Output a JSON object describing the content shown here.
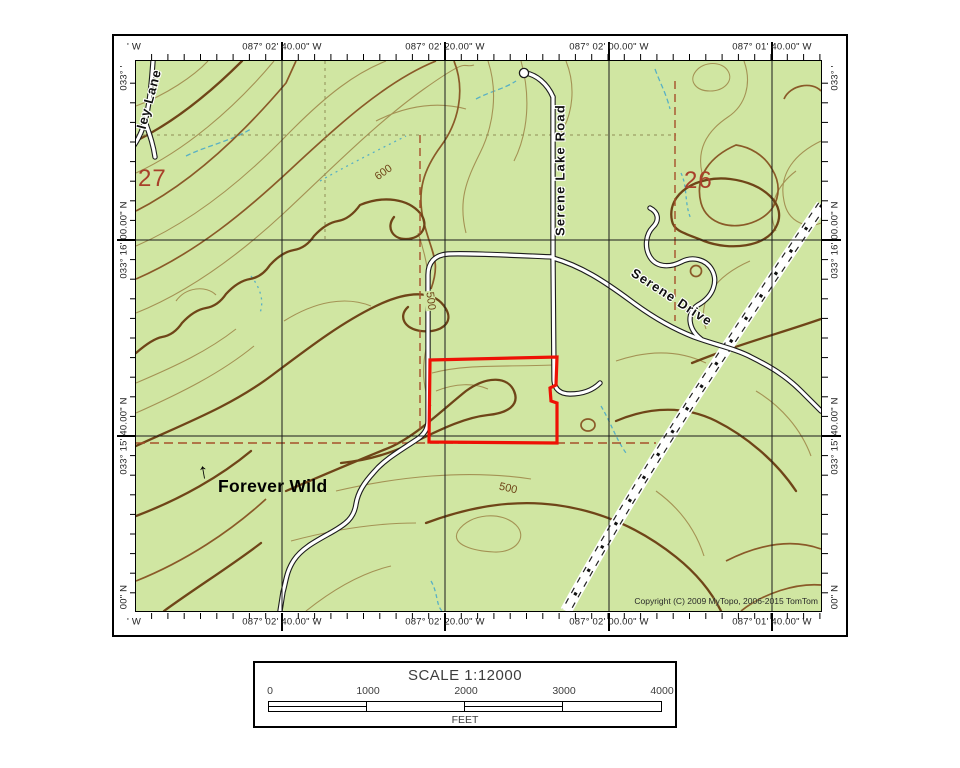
{
  "colors": {
    "map_green": "#d0e6a2",
    "contour_index": "#6f4518",
    "contour_medium": "#8a5a28",
    "contour_thin": "#a28e50",
    "stream": "#58b0c4",
    "grid": "#1a1a1a",
    "road_casing": "#1c1c1c",
    "road_fill": "#ffffff",
    "boundary_red": "#ee1105",
    "section_number": "#a8402a",
    "section_line": "#a5502a",
    "section_line_faint": "#8f8f55",
    "axis_text": "#222222"
  },
  "axis": {
    "top": [
      "' W",
      "087° 02' 40.00\" W",
      "087° 02' 20.00\" W",
      "087° 02' 00.00\" W",
      "087° 01' 40.00\" W"
    ],
    "bottom": [
      "' W",
      "087° 02' 40.00\" W",
      "087° 02' 20.00\" W",
      "087° 02' 00.00\" W",
      "087° 01' 40.00\" W"
    ],
    "left": [
      "033° '",
      "033° 16' 00.00\" N",
      "033° 15' 40.00\" N",
      "00\" N"
    ],
    "right": [
      "033° '",
      "033° 16' 00.00\" N",
      "033° 15' 40.00\" N",
      "00\" N"
    ]
  },
  "map": {
    "section_labels": {
      "s27": "27",
      "s26": "26"
    },
    "roads": {
      "serene_lake_road": "Serene Lake Road",
      "serene_drive": "Serene Drive",
      "ley_lane": "ley Lane"
    },
    "annotation": {
      "arrow": "↑",
      "text": "Forever Wild"
    },
    "contour_labels": {
      "c600": "600",
      "c500_upper": "500",
      "c500_lower": "500"
    },
    "copyright": "Copyright (C) 2009 MyTopo, 2006-2015 TomTom"
  },
  "scalebar": {
    "title": "SCALE 1:12000",
    "ticks": [
      "0",
      "1000",
      "2000",
      "3000",
      "4000"
    ],
    "unit": "FEET"
  }
}
